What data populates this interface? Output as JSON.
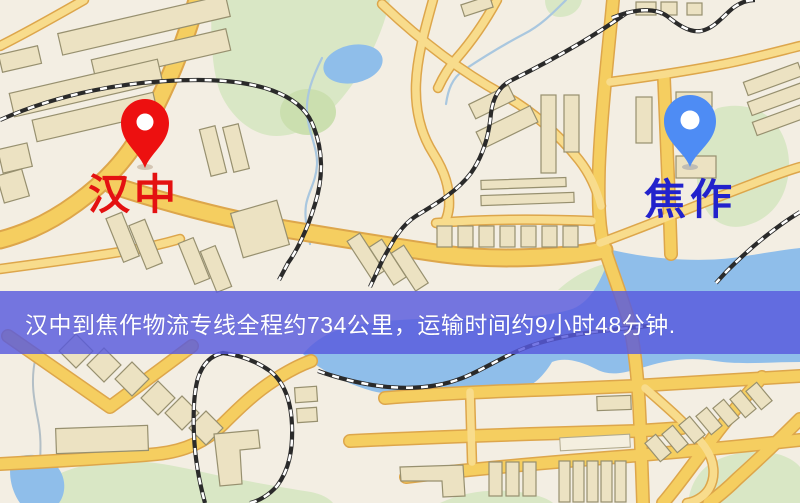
{
  "banner": {
    "text": "汉中到焦作物流专线全程约734公里，运输时间约9小时48分钟."
  },
  "route": {
    "origin": "汉中",
    "destination": "焦作",
    "distance_text": "约734公里",
    "duration_text": "约9小时48分钟"
  },
  "markers": [
    {
      "city": "汉中",
      "role": "origin",
      "pin_color": "#ed1010",
      "label_color": "#e41111"
    },
    {
      "city": "焦作",
      "role": "destination",
      "pin_color": "#4e8cf4",
      "label_color": "#2222cc"
    }
  ],
  "map_colors": {
    "background": "#f3eee3",
    "park_green": "#d9e7c5",
    "water_blue": "#8fbeea",
    "road_fill": "#f5ce60",
    "road_casing": "#dda64b",
    "minor_road_fill": "#f8dc8c",
    "building_fill": "#ece2c2",
    "building_outline": "#97906f",
    "railway_dark": "#2a2a2a",
    "banner_overlay": "rgba(88,90,222,0.82)",
    "banner_text_color": "#ffffff"
  }
}
